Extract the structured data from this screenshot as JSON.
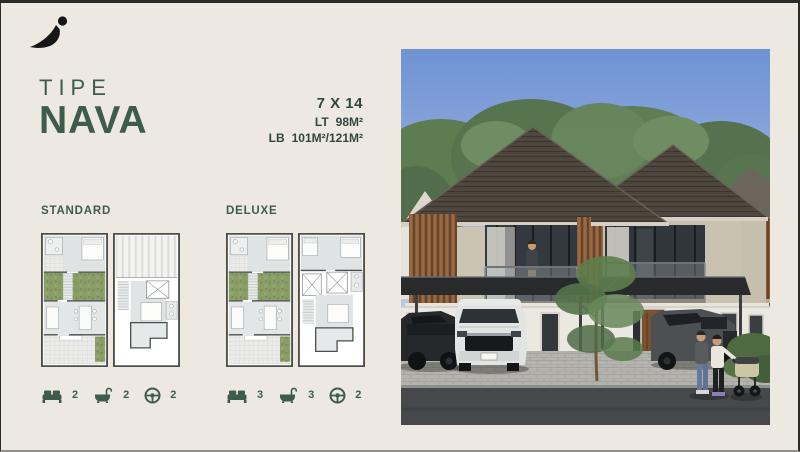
{
  "brand": {
    "logo": "abstract-swoosh-mark"
  },
  "title": {
    "small": "TIPE",
    "large": "NAVA"
  },
  "specs": {
    "size": "7 X 14",
    "rows": [
      {
        "label": "LT",
        "value": "98M²"
      },
      {
        "label": "LB",
        "value": "101M²/121M²"
      }
    ]
  },
  "variants": [
    {
      "name": "STANDARD",
      "features": [
        {
          "icon": "bed-icon",
          "count": "2"
        },
        {
          "icon": "bathtub-icon",
          "count": "2"
        },
        {
          "icon": "steering-wheel-icon",
          "count": "2"
        }
      ]
    },
    {
      "name": "DELUXE",
      "features": [
        {
          "icon": "bed-icon",
          "count": "3"
        },
        {
          "icon": "bathtub-icon",
          "count": "3"
        },
        {
          "icon": "steering-wheel-icon",
          "count": "2"
        }
      ]
    }
  ],
  "colors": {
    "background": "#EDE9E1",
    "accent_green": "#3E5C4B",
    "border_dark": "#2B2B28"
  }
}
